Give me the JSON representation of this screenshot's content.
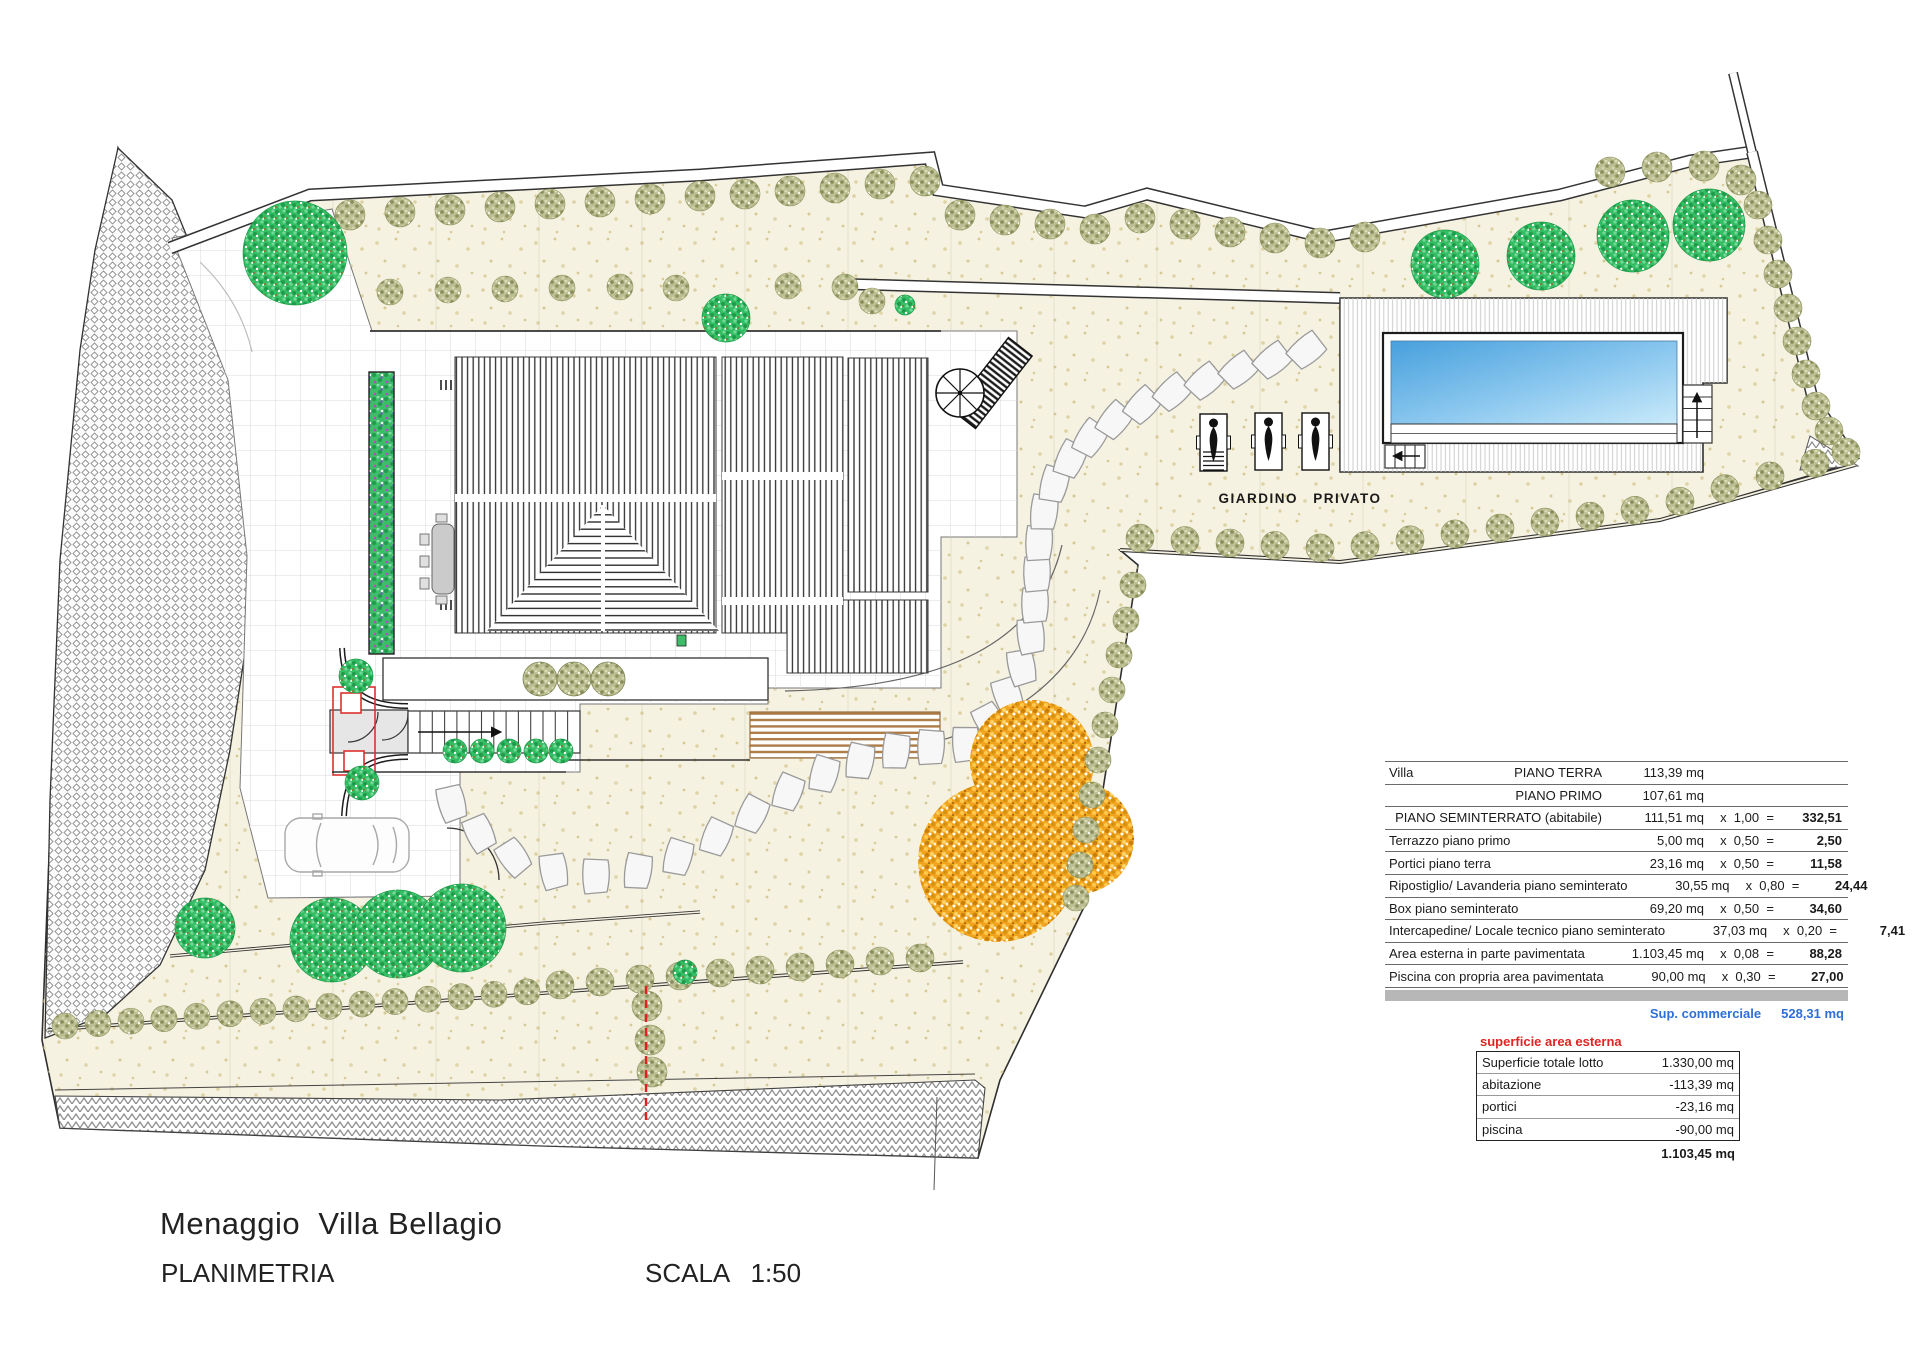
{
  "title_block": {
    "project": "Menaggio  Villa Bellagio",
    "drawing": "PLANIMETRIA",
    "scale": "SCALA   1:50"
  },
  "plan": {
    "garden_label": "GIARDINO  PRIVATO"
  },
  "colors": {
    "accent_blue": "#2E6FD8",
    "accent_red": "#E02424",
    "pool_blue_dark": "#47A0DD",
    "pool_blue_light": "#C9EAFA",
    "lawn_cream": "#F6F2E1"
  },
  "villa_table": {
    "rows": [
      {
        "label": "Villa",
        "mid": "PIANO TERRA",
        "mq": "113,39  mq",
        "factor": "",
        "result": ""
      },
      {
        "label": "",
        "mid": "PIANO PRIMO",
        "mq": "107,61  mq",
        "factor": "",
        "result": ""
      },
      {
        "label": "",
        "mid": "PIANO SEMINTERRATO (abitabile)",
        "mq": "111,51  mq",
        "factor": "x  1,00  =",
        "result": "332,51"
      },
      {
        "label": "Terrazzo piano primo",
        "mid": "",
        "mq": "5,00  mq",
        "factor": "x  0,50  =",
        "result": "2,50"
      },
      {
        "label": "Portici piano terra",
        "mid": "",
        "mq": "23,16  mq",
        "factor": "x  0,50  =",
        "result": "11,58"
      },
      {
        "label": "Ripostiglio/ Lavanderia piano seminterato",
        "mid": "",
        "mq": "30,55  mq",
        "factor": "x  0,80  =",
        "result": "24,44"
      },
      {
        "label": "Box  piano seminterato",
        "mid": "",
        "mq": "69,20  mq",
        "factor": "x  0,50  =",
        "result": "34,60"
      },
      {
        "label": "Intercapedine/ Locale tecnico  piano seminterato",
        "mid": "",
        "mq": "37,03  mq",
        "factor": "x  0,20  =",
        "result": "7,41"
      },
      {
        "label": "Area esterna in parte pavimentata",
        "mid": "",
        "mq": "1.103,45  mq",
        "factor": "x  0,08  =",
        "result": "88,28"
      },
      {
        "label": "Piscina con propria area pavimentata",
        "mid": "",
        "mq": "90,00  mq",
        "factor": "x  0,30  =",
        "result": "27,00"
      }
    ],
    "footer": {
      "label": "Sup. commerciale",
      "value": "528,31  mq"
    }
  },
  "esterna_table": {
    "heading": "superficie area esterna",
    "rows": [
      {
        "label": "Superficie totale lotto",
        "value": "1.330,00  mq"
      },
      {
        "label": "abitazione",
        "value": "-113,39  mq"
      },
      {
        "label": "portici",
        "value": "-23,16  mq"
      },
      {
        "label": "piscina",
        "value": "-90,00  mq"
      }
    ],
    "total": "1.103,45  mq"
  }
}
